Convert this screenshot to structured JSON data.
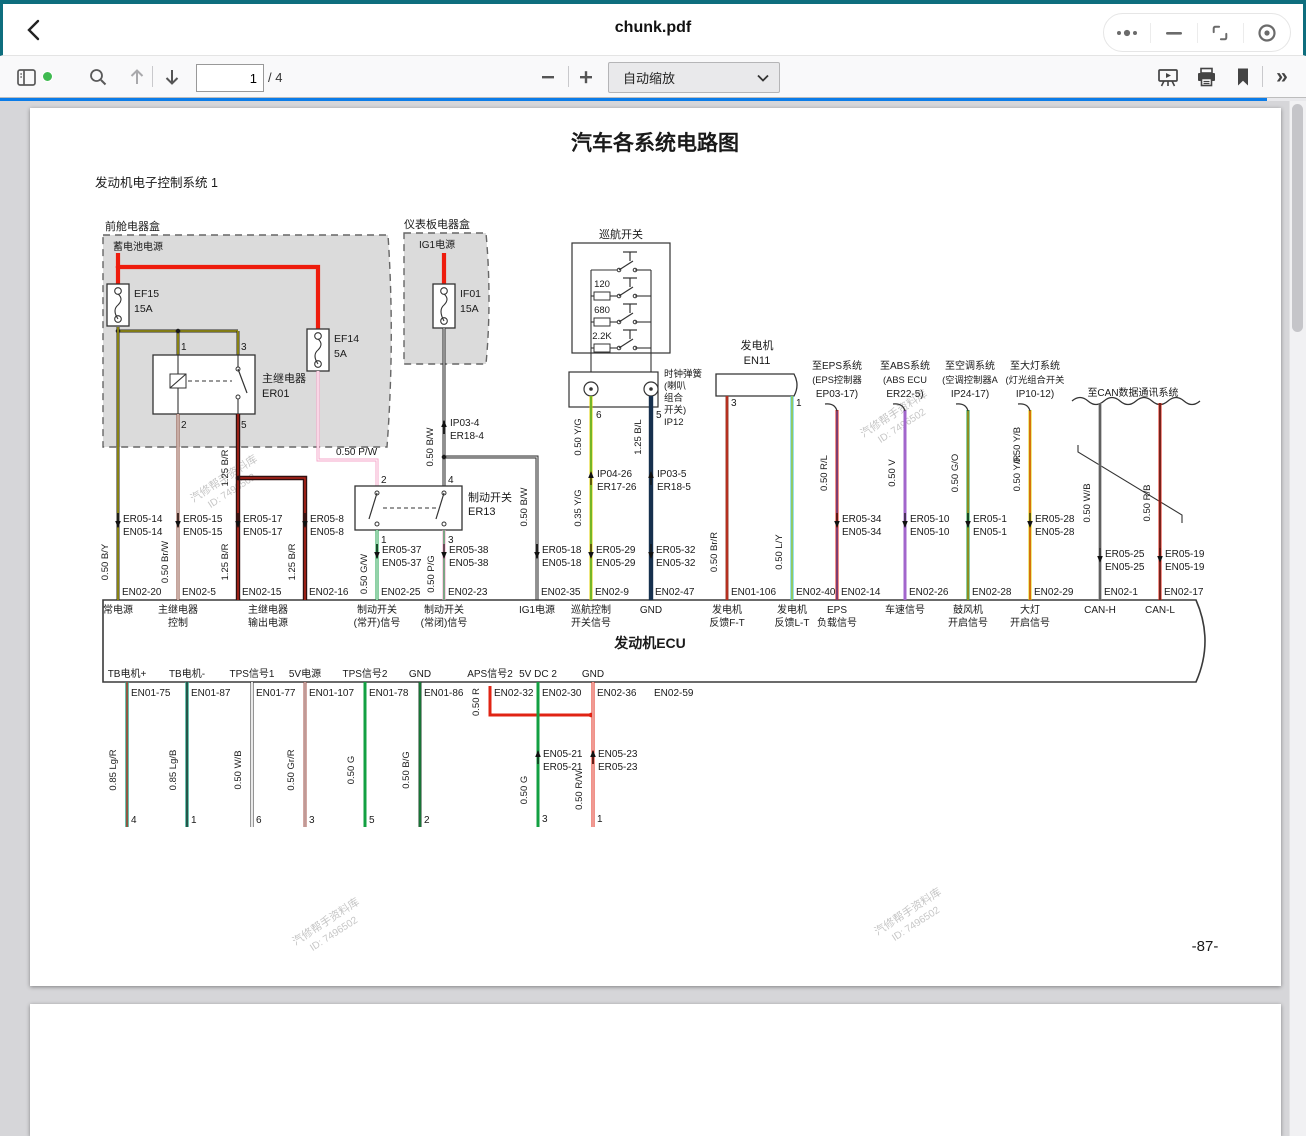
{
  "window": {
    "title": "chunk.pdf"
  },
  "toolbar": {
    "page_value": "1",
    "page_total": "/ 4",
    "zoom_label": "自动缩放"
  },
  "colors": {
    "frame_teal": "#0e6e7e",
    "progress_blue": "#0b7ce8",
    "sidebar_dot_green": "#3fba50"
  },
  "wire_colors": {
    "BY": {
      "m": "#2a2a2a",
      "s": "#d8cc00"
    },
    "BrW": {
      "m": "#8a4a3a",
      "s": "#ffffff"
    },
    "BR": {
      "m": "#301010",
      "s": "#b42418"
    },
    "PW": {
      "m": "#f4a6ca",
      "s": "#ffffff"
    },
    "GW": {
      "m": "#18a048",
      "s": "#ffffff"
    },
    "PG": {
      "m": "#f4a6ca",
      "s": "#18a048"
    },
    "BW": {
      "m": "#2a2a2a",
      "s": "#e6e6e6"
    },
    "YG": {
      "m": "#e0d000",
      "s": "#18a048"
    },
    "BL": {
      "m": "#16304e"
    },
    "BrR": {
      "m": "#9a4030",
      "s": "#cc2414"
    },
    "LY": {
      "m": "#30c2e2",
      "s": "#e0d000"
    },
    "RL": {
      "m": "#e02414",
      "s": "#3050c0"
    },
    "V": {
      "m": "#a266cc"
    },
    "GO": {
      "m": "#18a048",
      "s": "#f08000"
    },
    "YB": {
      "m": "#e0d000",
      "s": "#222222"
    },
    "YR": {
      "m": "#e0d000",
      "s": "#cc2414"
    },
    "WB": {
      "m": "#8c8c8c",
      "s": "#3c3c3c"
    },
    "RB": {
      "m": "#e02414",
      "s": "#222222"
    },
    "LgR": {
      "m": "#2ca88c",
      "s": "#cc2414"
    },
    "LgB": {
      "m": "#2ca88c",
      "s": "#222222"
    },
    "WD": {
      "m": "#2a2a2a",
      "s": "#ffffff"
    },
    "GrR": {
      "m": "#a65048",
      "s": "#d8d8d8"
    },
    "G": {
      "m": "#12a042"
    },
    "BG": {
      "m": "#20402a",
      "s": "#12a042"
    },
    "RW": {
      "m": "#e02414",
      "s": "#ffffff"
    },
    "Y": {
      "m": "#e8d400"
    },
    "P": {
      "m": "#f4a6ca"
    },
    "L": {
      "m": "#2896dc"
    },
    "PL": {
      "m": "#f4a6ca",
      "s": "#2896dc"
    },
    "B": {
      "m": "#1a1a1a"
    },
    "R": {
      "m": "#e02414"
    },
    "RED": {
      "m": "#ee1c0c"
    }
  },
  "page1": {
    "title": "汽车各系统电路图",
    "subtitle": "发动机电子控制系统 1",
    "page_no": "-87-",
    "watermark": [
      "汽修帮手资料库",
      "ID: 7496502"
    ],
    "front_box": {
      "label": "前舱电器盒",
      "battery": "蓄电池电源",
      "fuses": [
        {
          "id": "EF15",
          "amp": "15A"
        },
        {
          "id": "EF14",
          "amp": "5A"
        }
      ],
      "relay": {
        "name": "主继电器",
        "id": "ER01",
        "pins": [
          "1",
          "3",
          "2",
          "5"
        ]
      }
    },
    "dash_box": {
      "label": "仪表板电器盒",
      "source": "IG1电源",
      "fuse": {
        "id": "IF01",
        "amp": "15A"
      },
      "wire": "0.50 B/W",
      "conn": [
        "IP03-4",
        "ER18-4"
      ],
      "pw_label": "0.50 P/W"
    },
    "brake_switch": {
      "name": "制动开关",
      "id": "ER13",
      "pins": [
        "2",
        "4",
        "1",
        "3"
      ]
    },
    "cruise": {
      "label": "巡航开关",
      "resistors": [
        "120",
        "680",
        "2.2K"
      ]
    },
    "clockspring": {
      "lines": [
        "时钟弹簧",
        "(喇叭",
        "组合",
        "开关)",
        "IP12"
      ],
      "pins": [
        "6",
        "5"
      ]
    },
    "generator": {
      "name": "发电机",
      "id": "EN11",
      "pins": [
        "3",
        "1"
      ]
    },
    "branches": [
      {
        "lines": [
          "至EPS系统",
          "(EPS控制器",
          "EP03-17)"
        ]
      },
      {
        "lines": [
          "至ABS系统",
          "(ABS ECU",
          "ER22-5)"
        ]
      },
      {
        "lines": [
          "至空调系统",
          "(空调控制器A",
          "IP24-17)"
        ]
      },
      {
        "lines": [
          "至大灯系统",
          "(灯光组合开关",
          "IP10-12)"
        ]
      }
    ],
    "can_label": "至CAN数据通讯系统",
    "ecu_label": "发动机ECU",
    "top_pins": [
      {
        "code": "EN02-20",
        "func": [
          "常电源"
        ],
        "size": "0.50 B/Y",
        "conn": [
          "ER05-14",
          "EN05-14"
        ],
        "color": "BY"
      },
      {
        "code": "EN02-5",
        "func": [
          "主继电器",
          "控制"
        ],
        "size": "0.50 Br/W",
        "conn": [
          "ER05-15",
          "EN05-15"
        ],
        "color": "BrW"
      },
      {
        "code": "EN02-15",
        "func": [
          "主继电器",
          "输出电源"
        ],
        "size": "1.25 B/R",
        "size2": "1.25 B/R",
        "conn": [
          "ER05-17",
          "EN05-17"
        ],
        "color": "BR"
      },
      {
        "code": "EN02-16",
        "func": [],
        "size": "1.25 B/R",
        "conn": [
          "ER05-8",
          "EN05-8"
        ],
        "color": "BR"
      },
      {
        "code": "EN02-25",
        "func": [
          "制动开关",
          "(常开)信号"
        ],
        "size": "0.50 G/W",
        "conn": [
          "ER05-37",
          "EN05-37"
        ],
        "color": "GW"
      },
      {
        "code": "EN02-23",
        "func": [
          "制动开关",
          "(常闭)信号"
        ],
        "size": "0.50 P/G",
        "conn": [
          "ER05-38",
          "EN05-38"
        ],
        "color": "PG"
      },
      {
        "code": "EN02-35",
        "func": [
          "IG1电源"
        ],
        "size": "0.50 B/W",
        "conn": [
          "ER05-18",
          "EN05-18"
        ],
        "color": "BW"
      },
      {
        "code": "EN02-9",
        "func": [
          "巡航控制",
          "开关信号"
        ],
        "size": "0.35 Y/G",
        "size2": "0.50 Y/G",
        "conn": [
          "ER05-29",
          "EN05-29"
        ],
        "mid": [
          "IP04-26",
          "ER17-26"
        ],
        "color": "YG"
      },
      {
        "code": "EN02-47",
        "func": [
          "GND"
        ],
        "size2": "1.25 B/L",
        "conn": [
          "ER05-32",
          "EN05-32"
        ],
        "mid": [
          "IP03-5",
          "ER18-5"
        ],
        "color": "BL"
      },
      {
        "code": "EN01-106",
        "func": [
          "发电机",
          "反馈F-T"
        ],
        "size": "0.50 Br/R",
        "color": "BrR"
      },
      {
        "code": "EN02-40",
        "func": [
          "发电机",
          "反馈L-T"
        ],
        "size": "0.50 L/Y",
        "color": "LY"
      },
      {
        "code": "EN02-14",
        "func": [
          "EPS",
          "负载信号"
        ],
        "size": "0.50 R/L",
        "conn": [
          "ER05-34",
          "EN05-34"
        ],
        "color": "RL"
      },
      {
        "code": "EN02-26",
        "func": [
          "车速信号"
        ],
        "size": "0.50 V",
        "conn": [
          "ER05-10",
          "EN05-10"
        ],
        "color": "V"
      },
      {
        "code": "EN02-28",
        "func": [
          "鼓风机",
          "开启信号"
        ],
        "size": "0.50 G/O",
        "conn": [
          "ER05-1",
          "EN05-1"
        ],
        "color": "GO"
      },
      {
        "code": "EN02-29",
        "func": [
          "大灯",
          "开启信号"
        ],
        "size": "0.50 Y/R",
        "size2": "0.50 Y/B",
        "conn": [
          "ER05-28",
          "EN05-28"
        ],
        "color": "YR"
      },
      {
        "code": "EN02-1",
        "func": [
          "CAN-H"
        ],
        "size": "0.50 W/B",
        "conn": [
          "ER05-25",
          "EN05-25"
        ],
        "color": "WB"
      },
      {
        "code": "EN02-17",
        "func": [
          "CAN-L"
        ],
        "size": "0.50 R/B",
        "conn": [
          "ER05-19",
          "EN05-19"
        ],
        "color": "RB"
      }
    ],
    "bottom_pins": [
      {
        "func": [
          "TB电机+"
        ],
        "code": "EN01-75",
        "size": "0.85 Lg/R",
        "pin": "4",
        "color": "LgR"
      },
      {
        "func": [
          "TB电机-"
        ],
        "code": "EN01-87",
        "size": "0.85 Lg/B",
        "pin": "1",
        "color": "LgB"
      },
      {
        "func": [
          "TPS信号1"
        ],
        "code": "EN01-77",
        "size": "0.50 W/B",
        "pin": "6",
        "color": "WD"
      },
      {
        "func": [
          "5V电源"
        ],
        "code": "EN01-107",
        "size": "0.50 Gr/R",
        "pin": "3",
        "color": "GrR"
      },
      {
        "func": [
          "TPS信号2"
        ],
        "code": "EN01-78",
        "size": "0.50 G",
        "pin": "5",
        "color": "G"
      },
      {
        "func": [
          "GND"
        ],
        "code": "EN01-86",
        "size": "0.50 B/G",
        "pin": "2",
        "color": "BG"
      },
      {
        "func": [
          "APS信号2"
        ],
        "code": "EN02-32",
        "size": "0.50 R",
        "color": "R"
      },
      {
        "func": [
          "5V DC 2"
        ],
        "code": "EN02-30",
        "size": "0.50 G",
        "conn": [
          "EN05-21",
          "ER05-21"
        ],
        "pin": "3",
        "color": "G"
      },
      {
        "func": [
          "GND"
        ],
        "code": "EN02-36",
        "size": "0.50 R/W",
        "conn": [
          "EN05-23",
          "ER05-23"
        ],
        "pin": "1",
        "color": "RW"
      },
      {
        "func": [],
        "code": "EN02-59",
        "size": "0.50 W",
        "conn": [
          "EN05-26",
          "ER05-26"
        ],
        "pin": "5",
        "color": "W"
      },
      {
        "func": [
          "APS信号1"
        ],
        "code": "EN02-45",
        "size": "0.50 Y",
        "conn": [
          "EN05-24",
          "ER05-24"
        ],
        "pin": "6",
        "color": "Y"
      },
      {
        "func": [
          "5V DC 1"
        ],
        "code": "EN02-37",
        "size": "0.50 P",
        "conn": [
          "EN05-20",
          "ER05-20"
        ],
        "pin": "2",
        "color": "P"
      },
      {
        "func": [
          "GND"
        ],
        "code": "EN02-7",
        "size": "0.50 L",
        "conn": [
          "EN05-22",
          "ER05-22"
        ],
        "pin": "4",
        "color": "L"
      },
      {
        "func": [
          "离合器",
          "开关信号"
        ],
        "code": "EN02-6",
        "size": "0.50 P/L",
        "conn": [
          "EN05-13",
          "ER05-13"
        ],
        "pin": "1",
        "color": "PL"
      },
      {
        "func": [
          "GND"
        ],
        "code": "EN02-63",
        "size": "1.25 B",
        "color": "B"
      },
      {
        "func": [
          "GND"
        ],
        "code": "EN02-64",
        "size": "1.25 B",
        "color": "B"
      },
      {
        "func": [
          "GND"
        ],
        "code": "EN01-111",
        "size": "1.25 B",
        "color": "B"
      },
      {
        "func": [
          "GND"
        ],
        "code": "EN01-112",
        "size": "1.25 B",
        "color": "B"
      }
    ],
    "throttle": {
      "name": "电子节气门",
      "id": "EN21",
      "motor": "M"
    },
    "pedal": {
      "name": "电子油门踏板传感器",
      "id": "ER14"
    },
    "clutch": {
      "lines": [
        "离合器",
        "开关",
        "ER15"
      ],
      "sym": "E-",
      "pin2": "2"
    },
    "grounds": [
      "G101",
      "G007",
      "G006",
      "G004",
      "G005"
    ],
    "logos": {
      "baic_cn": "北汽集团",
      "baic_en": "BAIC GROUP",
      "changhe_cn": "昌河汽车",
      "changhe_en": "CHANGHE"
    }
  },
  "page2": {
    "title": "汽车各系统电路图",
    "left_header": "EN01 发动机 ECU   PP10001495-FCI",
    "right_header": "EN02 发动机 ECU   PP10001495-FCI/HL",
    "left_cells": [
      "101",
      "102",
      "103",
      "104",
      "106",
      "107",
      "108",
      "109",
      "111",
      "112"
    ],
    "right_cells": [
      "56",
      "59",
      "62",
      "63",
      "64"
    ]
  }
}
